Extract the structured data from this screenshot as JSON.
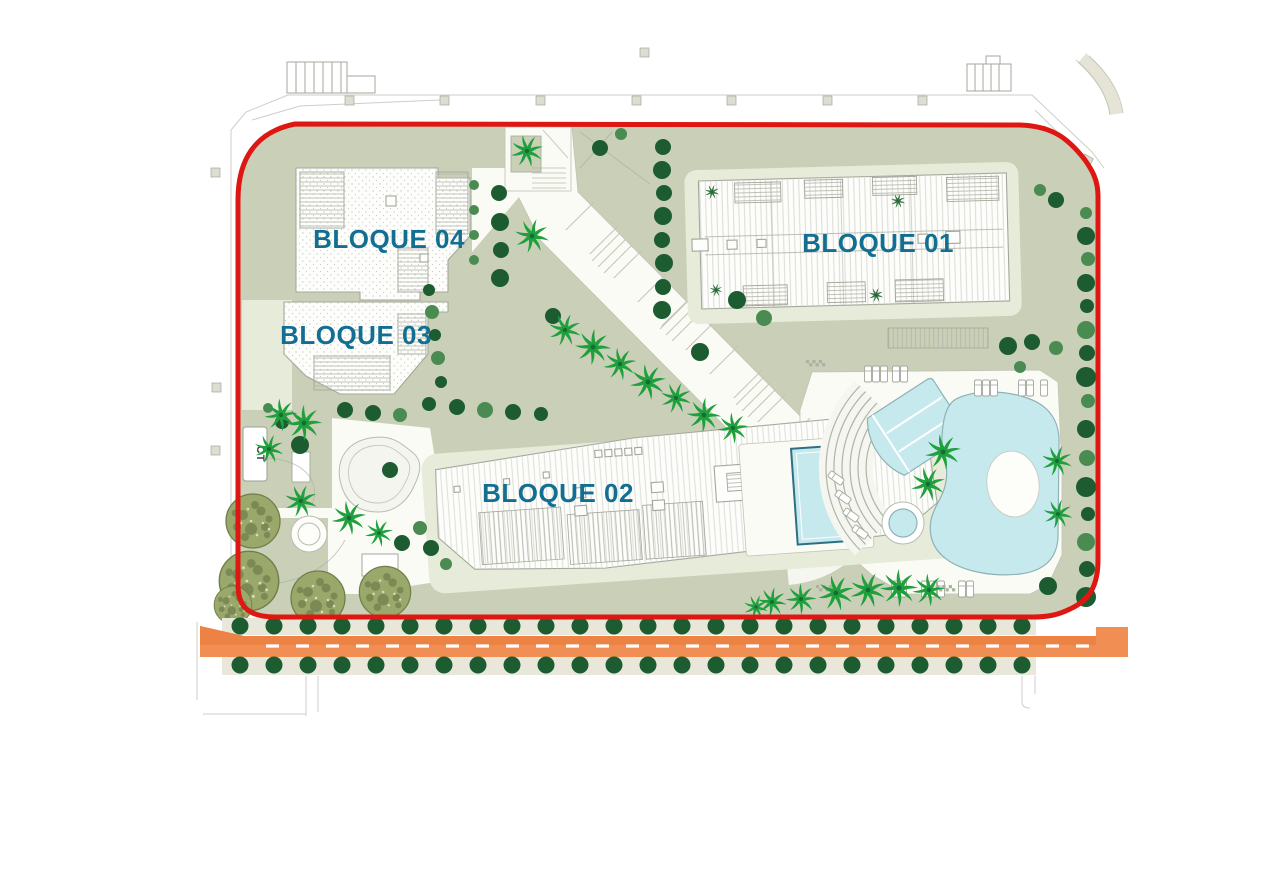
{
  "plan": {
    "labels": {
      "block01": "BLOQUE 01",
      "block02": "BLOQUE 02",
      "block03": "BLOQUE 03",
      "block04": "BLOQUE 04",
      "transformer": "CT"
    },
    "colors": {
      "boundary_red": "#de1712",
      "label_teal": "#136f92",
      "sage": "#cad0b7",
      "pale_pad": "#e7ebd9",
      "walk_white": "#fafbf5",
      "strip_beige": "#e9e7d9",
      "building_white": "#fdfdfb",
      "line_gray": "#a3a79b",
      "pool_blue": "#c6e9ee",
      "pool_edge": "#8fb2b6",
      "rooftop_pool_edge": "#2e7083",
      "tree_dark": "#1c5c30",
      "tree_mid": "#4a8b52",
      "palm_green": "#20a03d",
      "palm_dark": "#146c38",
      "olive_fill": "#9aa86b",
      "olive_edge": "#707f48",
      "olive_spot": "#5c6c3d",
      "road_orange": "#f18e54",
      "road_orange_dark": "#ec8243",
      "road_dash": "#ffffff",
      "ct_text": "#3f3f3f"
    },
    "road": {
      "y": 636,
      "height": 21,
      "x_start": 200,
      "x_end": 1098,
      "tree_rows": {
        "top_y": 626,
        "bottom_y": 665,
        "x_start": 240,
        "spacing": 34,
        "count": 24,
        "radius": 8.5
      }
    }
  }
}
